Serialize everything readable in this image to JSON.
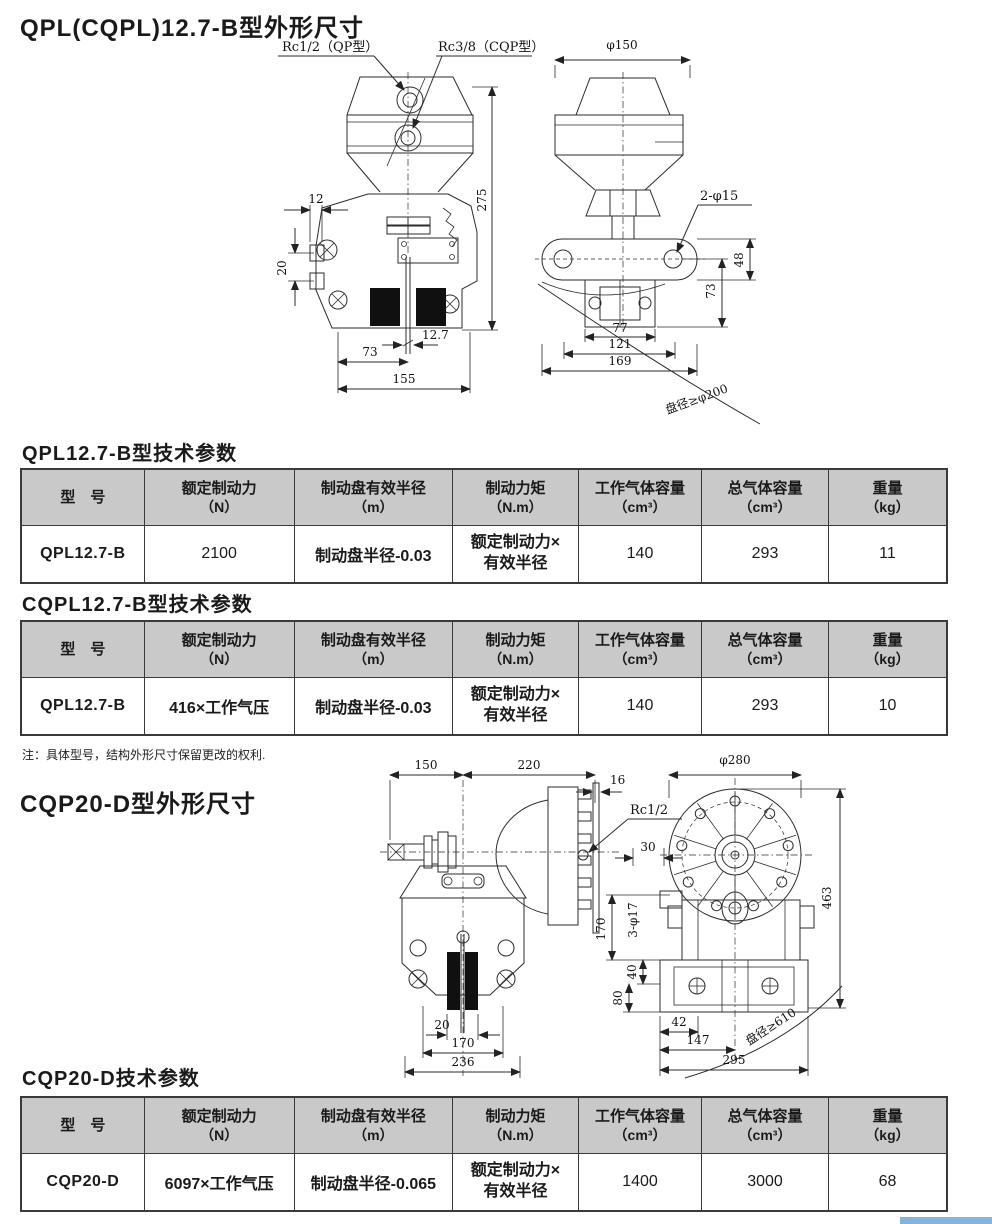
{
  "page": {
    "title1": "QPL(CQPL)12.7-B型外形尺寸",
    "table1_title": "QPL12.7-B型技术参数",
    "table2_title": "CQPL12.7-B型技术参数",
    "note": "注：具体型号，结构外形尺寸保留更改的权利.",
    "title2": "CQP20-D型外形尺寸",
    "table3_title": "CQP20-D技术参数"
  },
  "colors": {
    "table_header_bg": "#c9c9c9",
    "accent_bar": "#85b3e0",
    "line": "#2b2b2b"
  },
  "table_headers": {
    "c0": "型　号",
    "c1a": "额定制动力",
    "c1b": "（N）",
    "c2a": "制动盘有效半径",
    "c2b": "（m）",
    "c3a": "制动力矩",
    "c3b": "（N.m）",
    "c4a": "工作气体容量",
    "c4b": "（cm³）",
    "c5a": "总气体容量",
    "c5b": "（cm³）",
    "c6a": "重量",
    "c6b": "（kg）"
  },
  "table1": {
    "model": "QPL12.7-B",
    "force": "2100",
    "radius": "制动盘半径-0.03",
    "torque": "额定制动力×\n有效半径",
    "working_vol": "140",
    "total_vol": "293",
    "weight": "11"
  },
  "table2": {
    "model": "QPL12.7-B",
    "force": "416×工作气压",
    "radius": "制动盘半径-0.03",
    "torque": "额定制动力×\n有效半径",
    "working_vol": "140",
    "total_vol": "293",
    "weight": "10"
  },
  "table3": {
    "model": "CQP20-D",
    "force": "6097×工作气压",
    "radius": "制动盘半径-0.065",
    "torque": "额定制动力×\n有效半径",
    "working_vol": "1400",
    "total_vol": "3000",
    "weight": "68"
  },
  "drawing1": {
    "rc_qp": "Rc1/2（QP型）",
    "rc_cqp": "Rc3/8（CQP型）",
    "d12": "12",
    "d20": "20",
    "d73a": "73",
    "d155": "155",
    "d12_7": "12.7",
    "d275": "275",
    "phi150": "φ150",
    "two_phi15": "2-φ15",
    "d48": "48",
    "d73b": "73",
    "d77": "77",
    "d121": "121",
    "d169": "169",
    "disc": "盘径≥φ200"
  },
  "drawing2": {
    "d150": "150",
    "d220": "220",
    "d16": "16",
    "rc12": "Rc1/2",
    "d20": "20",
    "d170a": "170",
    "d236": "236",
    "phi280": "φ280",
    "d463": "463",
    "d30": "30",
    "three_phi17": "3-φ17",
    "d170b": "170",
    "d40": "40",
    "d80": "80",
    "d42": "42",
    "d147": "147",
    "d295": "295",
    "disc": "盘径≥610"
  }
}
